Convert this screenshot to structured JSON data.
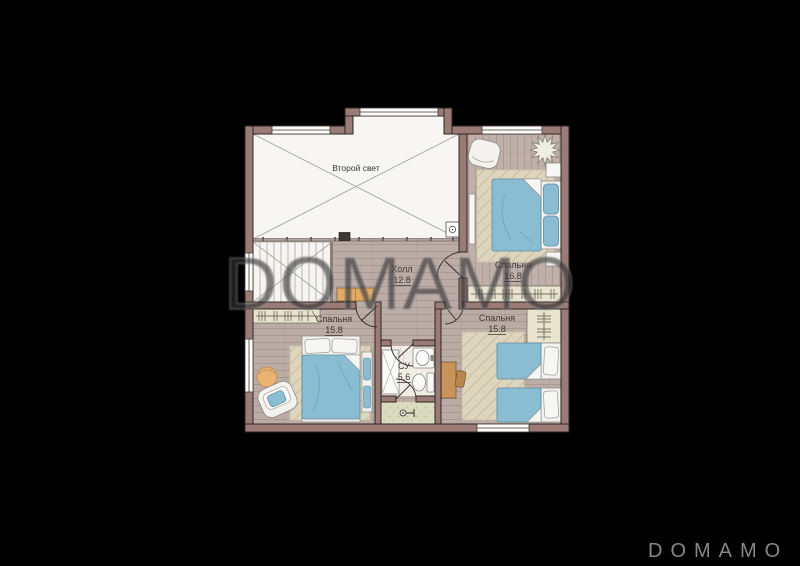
{
  "watermark": {
    "text": "DOMAMO"
  },
  "logo": {
    "text": "DOMAMO"
  },
  "plan": {
    "floor_title": "План второго этажа",
    "rooms": {
      "second_light": {
        "name": "Второй свет"
      },
      "hall": {
        "name": "Холл",
        "area": "12.8"
      },
      "bedroom_top": {
        "name": "Спальня",
        "area": "16.8"
      },
      "bedroom_left": {
        "name": "Спальня",
        "area": "15.8"
      },
      "bedroom_right": {
        "name": "Спальня",
        "area": "15.8"
      },
      "bathroom": {
        "name": "СУ",
        "area": "5.6"
      }
    },
    "colors": {
      "background": "#000000",
      "wall": "#9b7b76",
      "wall_outline": "#2e2522",
      "floor_wood": "#bcaca6",
      "void_white": "#f7f6f3",
      "rug_beige": "#ddd5bd",
      "furniture_blue": "#8abcd2",
      "wardrobe_beige": "#e8e4cd",
      "wood_accent": "#e4ac62",
      "tile_green": "#dbdbc1",
      "watermark_gray": "#303030",
      "logo_gray": "#878787"
    }
  }
}
